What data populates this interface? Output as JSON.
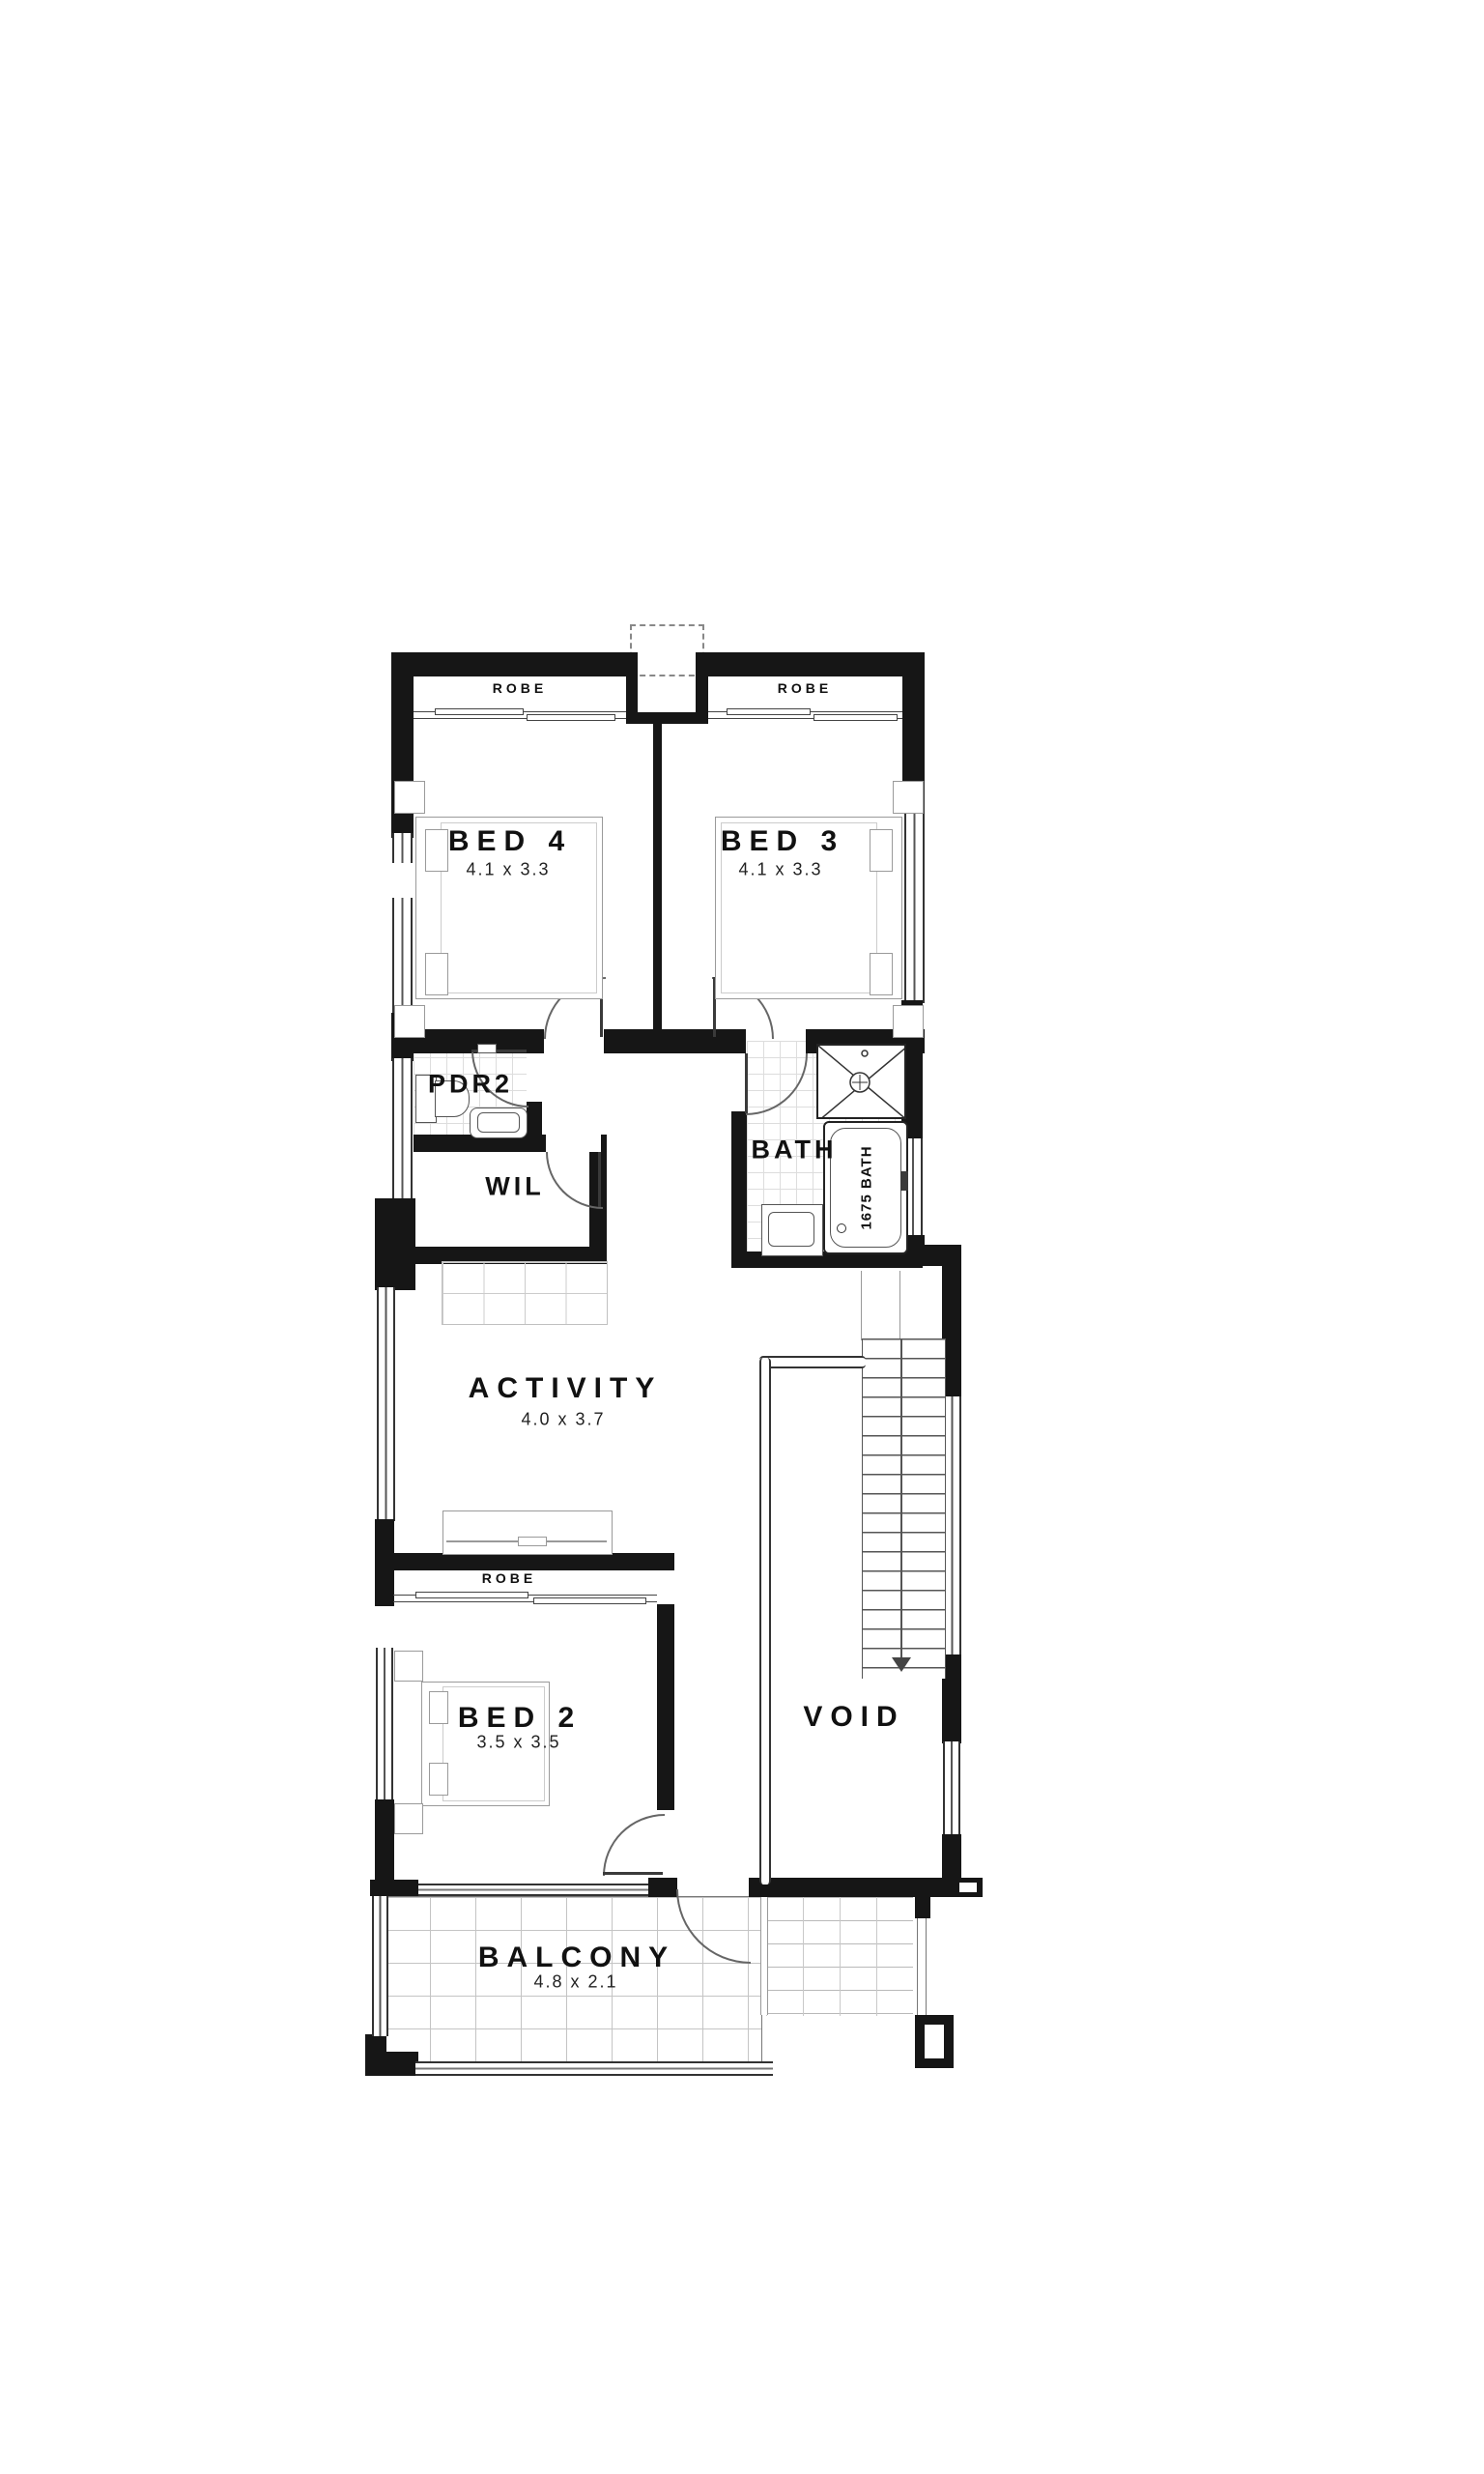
{
  "plan": {
    "rooms": {
      "bed4": {
        "name": "BED 4",
        "dims": "4.1 x 3.3"
      },
      "bed3": {
        "name": "BED 3",
        "dims": "4.1 x 3.3"
      },
      "bed2": {
        "name": "BED 2",
        "dims": "3.5 x 3.5"
      },
      "activity": {
        "name": "ACTIVITY",
        "dims": "4.0 x 3.7"
      },
      "balcony": {
        "name": "BALCONY",
        "dims": "4.8 x 2.1"
      },
      "pdr2": {
        "name": "PDR2"
      },
      "wil": {
        "name": "WIL"
      },
      "bath": {
        "name": "BATH"
      },
      "void": {
        "name": "VOID"
      }
    },
    "labels": {
      "robe_bed4": "ROBE",
      "robe_bed3": "ROBE",
      "robe_bed2": "ROBE",
      "bath_tub": "1675 BATH",
      "north_marker": "(N)"
    },
    "colors": {
      "wall": "#161616",
      "line": "#555555",
      "light_line": "#bbbbbb",
      "text": "#111111"
    }
  }
}
